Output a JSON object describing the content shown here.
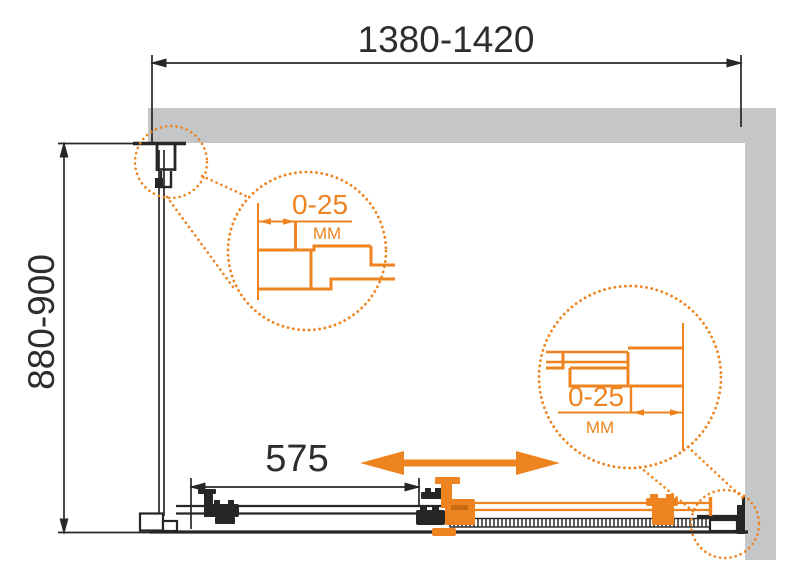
{
  "dimensions": {
    "width": "1380-1420",
    "depth": "880-900",
    "door_width": "575"
  },
  "details": {
    "left": {
      "value": "0-25",
      "unit": "MM"
    },
    "right": {
      "value": "0-25",
      "unit": "MM"
    }
  },
  "colors": {
    "accent": "#EE8420",
    "wall": "#C5C6C8",
    "line": "#262626"
  }
}
